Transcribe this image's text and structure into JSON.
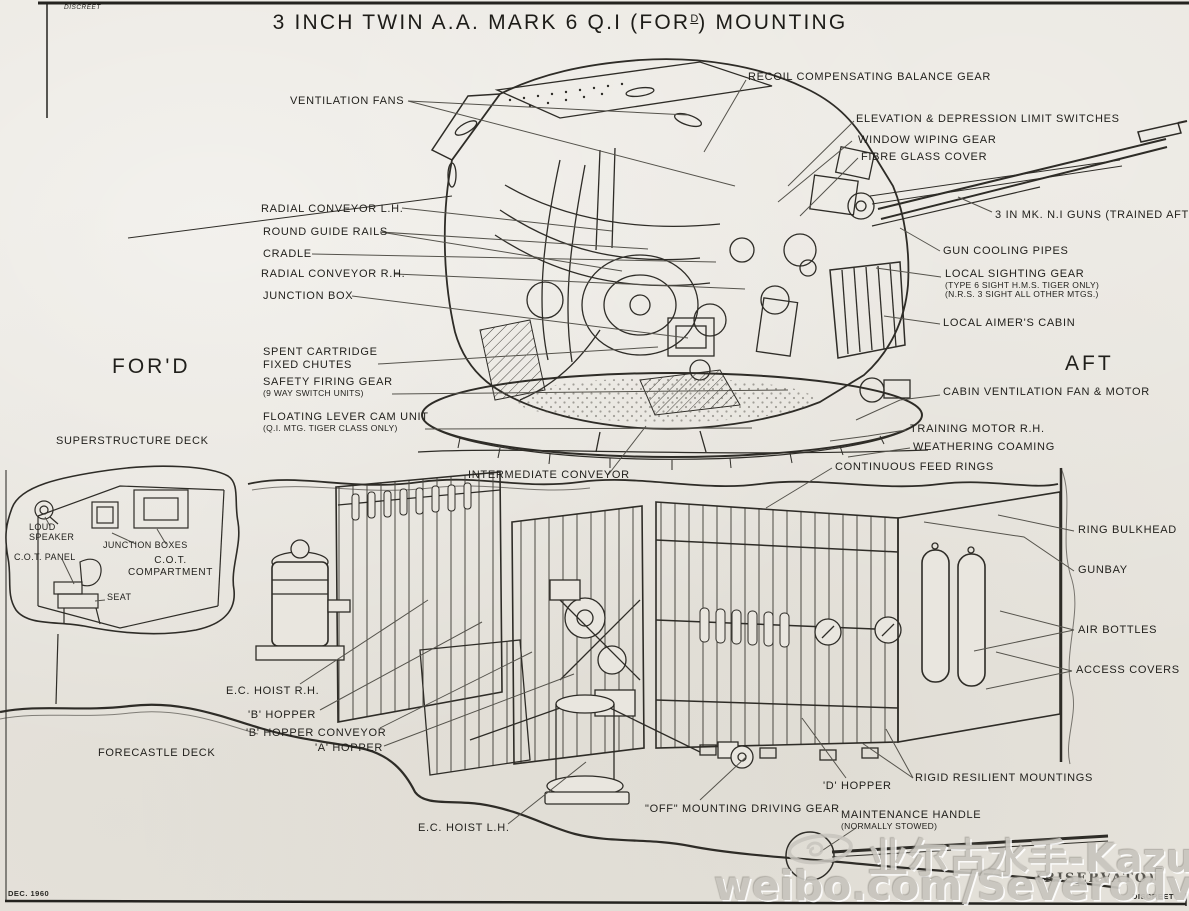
{
  "page": {
    "classification_top_left": "DISCREET",
    "classification_bottom_right": "DISCREET",
    "date_stamp": "DEC. 1960",
    "restricted_stamp": "(RISERVATO)"
  },
  "title": {
    "pre": "3 INCH TWIN A.A. MARK 6 Q.I (FOR",
    "sup": "D",
    "post": ") MOUNTING"
  },
  "orientation": {
    "fore": "FOR'D",
    "aft": "AFT"
  },
  "labels": {
    "ventilation_fans": [
      "VENTILATION FANS"
    ],
    "radial_conveyor_lh": [
      "RADIAL CONVEYOR L.H."
    ],
    "round_guide_rails": [
      "ROUND GUIDE RAILS"
    ],
    "cradle": [
      "CRADLE"
    ],
    "radial_conveyor_rh": [
      "RADIAL CONVEYOR R.H."
    ],
    "junction_box": [
      "JUNCTION BOX"
    ],
    "spent_cartridge_fixed_chutes": [
      "SPENT CARTRIDGE",
      "FIXED CHUTES"
    ],
    "safety_firing_gear": [
      "SAFETY FIRING GEAR",
      "(9 WAY SWITCH UNITS)"
    ],
    "floating_lever_cam_unit": [
      "FLOATING LEVER CAM UNIT",
      "(Q.I. MTG. TIGER CLASS ONLY)"
    ],
    "superstructure_deck": [
      "SUPERSTRUCTURE DECK"
    ],
    "loud_speaker": [
      "LOUD",
      "SPEAKER"
    ],
    "junction_boxes": [
      "JUNCTION BOXES"
    ],
    "cot_panel": [
      "C.O.T. PANEL"
    ],
    "cot_compartment": [
      "C.O.T.",
      "COMPARTMENT"
    ],
    "seat": [
      "SEAT"
    ],
    "intermediate_conveyor": [
      "INTERMEDIATE CONVEYOR"
    ],
    "ec_hoist_rh": [
      "E.C. HOIST R.H."
    ],
    "b_hopper": [
      "'B' HOPPER"
    ],
    "b_hopper_conveyor": [
      "'B' HOPPER CONVEYOR"
    ],
    "a_hopper": [
      "'A' HOPPER"
    ],
    "forecastle_deck": [
      "FORECASTLE DECK"
    ],
    "ec_hoist_lh": [
      "E.C. HOIST L.H."
    ],
    "off_mounting_driving_gear": [
      "\"OFF\" MOUNTING DRIVING GEAR"
    ],
    "d_hopper": [
      "'D' HOPPER"
    ],
    "rigid_resilient_mountings": [
      "RIGID RESILIENT MOUNTINGS"
    ],
    "maintenance_handle": [
      "MAINTENANCE HANDLE",
      "(NORMALLY STOWED)"
    ],
    "recoil_compensating_balance_gear": [
      "RECOIL COMPENSATING BALANCE GEAR"
    ],
    "elevation_depression_limit_switches": [
      "ELEVATION & DEPRESSION LIMIT SWITCHES"
    ],
    "window_wiping_gear": [
      "WINDOW WIPING GEAR"
    ],
    "fibre_glass_cover": [
      "FIBRE GLASS COVER"
    ],
    "guns": [
      "3 IN MK. N.I GUNS (TRAINED AFT)"
    ],
    "gun_cooling_pipes": [
      "GUN COOLING PIPES"
    ],
    "local_sighting_gear": [
      "LOCAL SIGHTING GEAR",
      "(TYPE 6 SIGHT H.M.S. TIGER ONLY)",
      "(N.R.S. 3 SIGHT ALL OTHER MTGS.)"
    ],
    "local_aimers_cabin": [
      "LOCAL AIMER'S CABIN"
    ],
    "cabin_ventilation_fan_motor": [
      "CABIN VENTILATION FAN & MOTOR"
    ],
    "training_motor_rh": [
      "TRAINING MOTOR R.H."
    ],
    "weathering_coaming": [
      "WEATHERING COAMING"
    ],
    "continuous_feed_rings": [
      "CONTINUOUS FEED RINGS"
    ],
    "ring_bulkhead": [
      "RING BULKHEAD"
    ],
    "gunbay": [
      "GUNBAY"
    ],
    "air_bottles": [
      "AIR BOTTLES"
    ],
    "access_covers": [
      "ACCESS COVERS"
    ]
  },
  "watermark": {
    "line1": "业尔古水手-Kazusa",
    "line2": "weibo.com/Severodvinsk"
  },
  "colors": {
    "paper": "#e9e6df",
    "ink": "#2e2c27",
    "leader": "#55534c",
    "watermark": "#c8c5be"
  }
}
